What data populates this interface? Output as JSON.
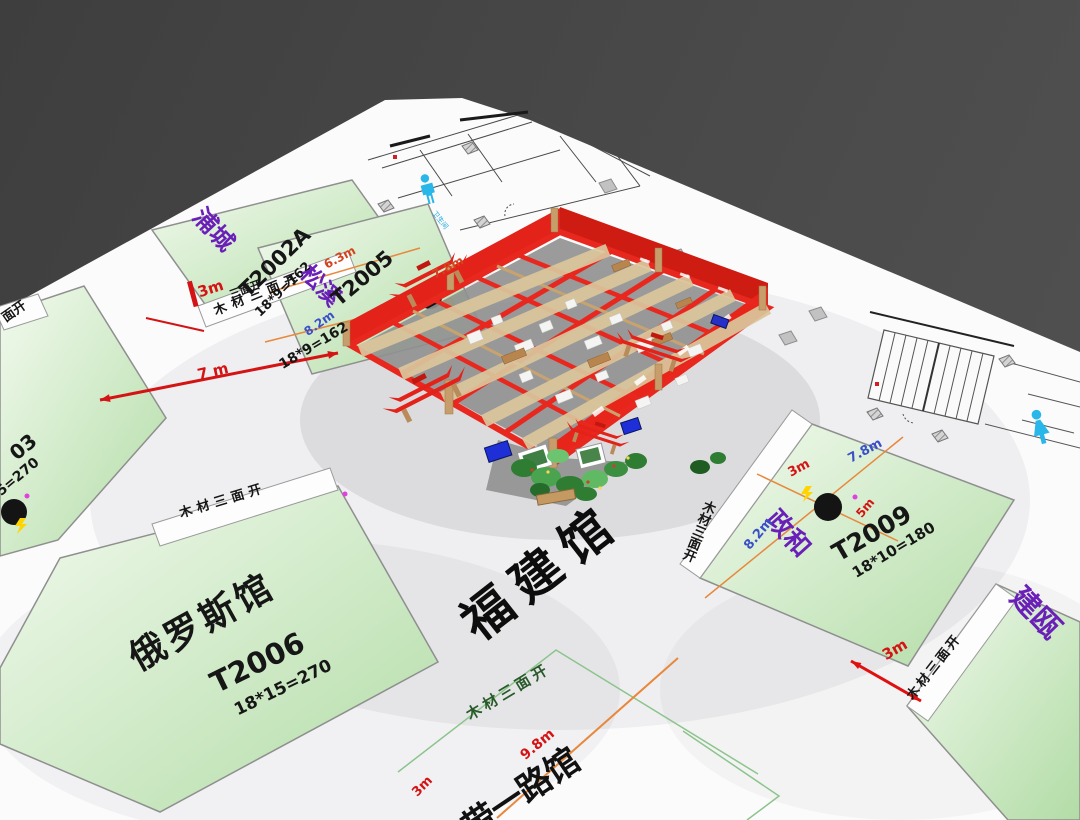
{
  "scene": {
    "background_color": "#474747",
    "floor_color": "#fbfbfc"
  },
  "aisle_label": "福建馆",
  "open_side_label": "木材三面开",
  "open_side_partial_short": "面开",
  "open_side_partial_mid": "三面开",
  "restroom_label": "卫生间",
  "aisle_dims": {
    "d7m": "7 m",
    "d3m_a": "3m"
  },
  "booths": [
    {
      "name": "浦城",
      "code": "T2002A",
      "area": "18*9=162"
    },
    {
      "name": "松溪",
      "code": "T2005",
      "area": "18*9=162",
      "dims": {
        "top": "6.3m",
        "left": "8.2m",
        "right": "7.8m"
      }
    },
    {
      "code": "03",
      "area": "5=270"
    },
    {
      "name": "俄罗斯馆",
      "code": "T2006",
      "area": "18*15=270"
    },
    {
      "name": "政和",
      "code": "T2009",
      "area": "18*10=180",
      "dims": {
        "top_left": "3m",
        "top_right": "7.8m",
        "left": "8.2m",
        "right": "5m"
      }
    },
    {
      "name": "建瓯",
      "dim": "3m"
    },
    {
      "name": "带一路馆",
      "dim_a": "9.8m",
      "dim_b": "3m"
    }
  ],
  "colors": {
    "booth_green": "#cfe8c3",
    "name_purple": "#6a1fb8",
    "dim_red": "#d41414",
    "dim_blue": "#3a50c8",
    "line_orange": "#e8883c",
    "structure_red": "#e32219",
    "wood": "#c79e6b",
    "restroom_cyan": "#29b6e8"
  }
}
